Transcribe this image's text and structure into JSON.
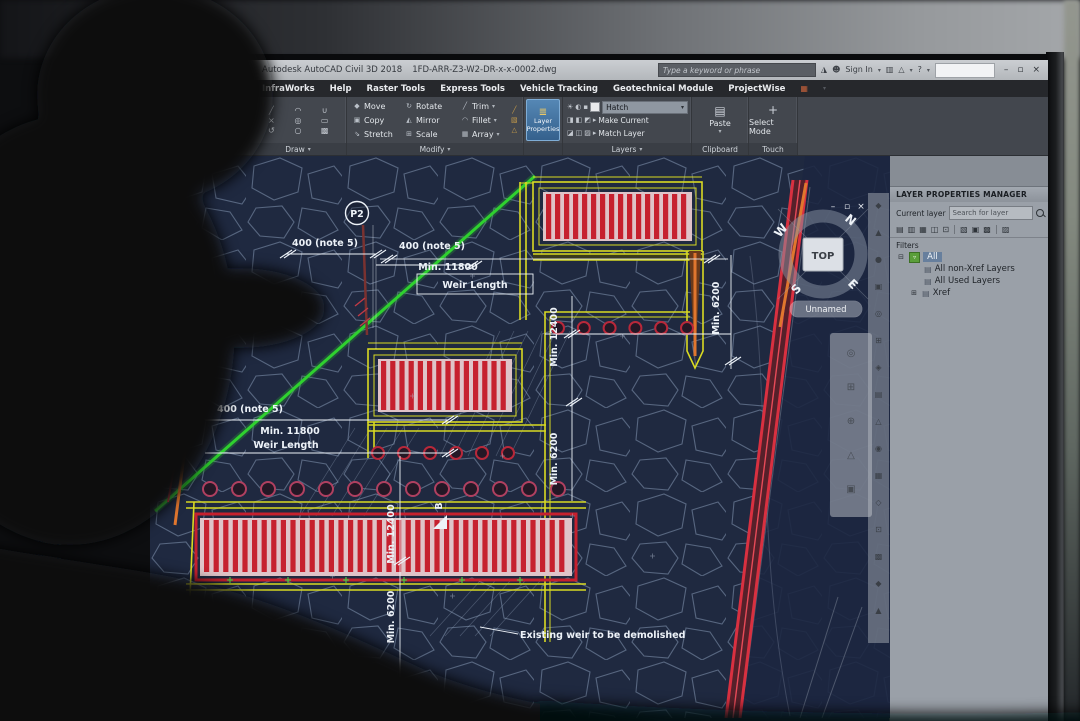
{
  "window": {
    "app_title": "Autodesk AutoCAD Civil 3D 2018",
    "doc_name": "1FD-ARR-Z3-W2-DR-x-x-0002.dwg",
    "search_placeholder": "Type a keyword or phrase",
    "sign_in": "Sign In",
    "min": "–",
    "restore": "▫",
    "close": "×"
  },
  "menubar": {
    "items": [
      "InfraWorks",
      "Help",
      "Raster Tools",
      "Express Tools",
      "Vehicle Tracking",
      "Geotechnical Module",
      "ProjectWise"
    ]
  },
  "ribbon": {
    "draw": {
      "label": "Draw"
    },
    "modify": {
      "label": "Modify",
      "move": "Move",
      "rotate": "Rotate",
      "trim": "Trim",
      "copy": "Copy",
      "mirror": "Mirror",
      "fillet": "Fillet",
      "stretch": "Stretch",
      "scale": "Scale",
      "array": "Array"
    },
    "layer_properties": "Layer Properties",
    "layers": {
      "label": "Layers",
      "hatch": "Hatch",
      "make_current": "Make Current",
      "match_layer": "Match Layer"
    },
    "clipboard": {
      "label": "Clipboard",
      "paste": "Paste"
    },
    "touch": {
      "label": "Touch",
      "select_mode": "Select Mode"
    }
  },
  "layer_manager": {
    "title": "LAYER PROPERTIES MANAGER",
    "current_layer": "Current layer",
    "search_placeholder": "Search for layer",
    "filters": "Filters",
    "tree": {
      "all": "All",
      "non_xref": "All non-Xref Layers",
      "used": "All Used Layers",
      "xref": "Xref"
    }
  },
  "drawing": {
    "p2": "P2",
    "note_400_top_left": "400 (note 5)",
    "note_400_top_right": "400 (note 5)",
    "note_400_left": "400 (note 5)",
    "min_11800_top": "Min. 11800",
    "weir_length_top": "Weir Length",
    "min_11800_left": "Min. 11800",
    "weir_length_left": "Weir Length",
    "min_12400_mid": "Min. 12400",
    "min_6200_mid": "Min. 6200",
    "min_12400_left": "Min. 12400",
    "min_6200_left": "Min. 6200",
    "min_6200_right": "Min. 6200",
    "section_b": "B",
    "demolish_note": "Existing weir to be demolished",
    "view_pill": "Unnamed",
    "viewcube": {
      "top": "TOP",
      "n": "N",
      "e": "E",
      "s": "S",
      "w": "W"
    },
    "doc_min": "–",
    "doc_restore": "▫",
    "doc_close": "×"
  },
  "icons": {
    "caret": "▾",
    "menu_extra": "▦",
    "app_logo": "◮",
    "person": "☻",
    "cart": "▥",
    "warn": "△",
    "help": "?",
    "draw_glyphs": [
      "╱",
      "◠",
      "∪",
      "×",
      "◎",
      "▭",
      "↺",
      "○",
      "▩"
    ],
    "modify": {
      "move": "◆",
      "rotate": "↻",
      "trim": "╱",
      "copy": "▣",
      "mirror": "◭",
      "fillet": "◠",
      "stretch": "⇘",
      "scale": "⊞",
      "array": "▦"
    },
    "modify_extra": [
      "╱",
      "▧",
      "△"
    ],
    "layer_props": "≣",
    "layers_row1": [
      "☀",
      "◐",
      "▪"
    ],
    "layers_row2": [
      "◨",
      "◧",
      "◩",
      "▸"
    ],
    "layers_row3": [
      "◪",
      "◫",
      "▨",
      "▸"
    ],
    "paste": "▤",
    "select_mode": "+",
    "expander_open": "⊟",
    "expander_closed": "⊞",
    "all_filter": "▿",
    "folder": "▤",
    "panel_toolbar": [
      "▤",
      "▥",
      "▦",
      "◫",
      "⊡",
      "▧",
      "▣",
      "▩",
      "▨"
    ],
    "navbar": [
      "◆",
      "▲",
      "●",
      "▣",
      "◎",
      "⊞",
      "◈",
      "▤",
      "△",
      "◉",
      "▦",
      "◇",
      "⊡",
      "▩",
      "◆",
      "▲"
    ],
    "palette": [
      "◎",
      "⊞",
      "⊕",
      "△",
      "▣"
    ]
  },
  "colors": {
    "canvas_bg": "#1f2940",
    "riprap": "#8fa3bf",
    "yellow": "#d9da22",
    "red": "#c6202e",
    "pink": "#dfc3c8",
    "green": "#2fd12f",
    "band": "#d93040",
    "orange": "#e0762e",
    "dim": "#edf2f8"
  }
}
